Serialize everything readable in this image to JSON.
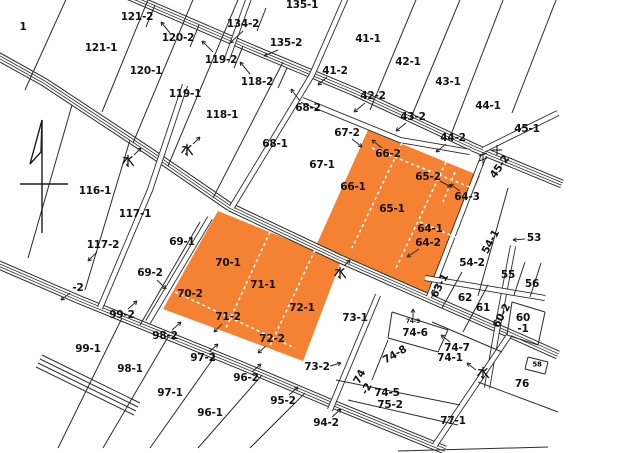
{
  "map": {
    "type": "cadastral-parcel-map",
    "colors": {
      "highlight": "#F58233",
      "line": "#2b2b2b",
      "background": "#ffffff",
      "text": "#121212"
    },
    "highlighted_parcels": {
      "upper_block": [
        "66-2",
        "66-1",
        "65-2",
        "65-1",
        "64-3",
        "64-1",
        "64-2"
      ],
      "lower_block": [
        "70-1",
        "70-2",
        "71-1",
        "71-2",
        "72-1",
        "72-2"
      ]
    },
    "water_mark_meaning": "水",
    "labels": [
      {
        "text": "1",
        "x": 23,
        "y": 27
      },
      {
        "text": "121-2",
        "x": 137,
        "y": 17
      },
      {
        "text": "134-2",
        "x": 243,
        "y": 24
      },
      {
        "text": "135-1",
        "x": 302,
        "y": 5
      },
      {
        "text": "120-2",
        "x": 178,
        "y": 38
      },
      {
        "text": "135-2",
        "x": 286,
        "y": 43
      },
      {
        "text": "41-1",
        "x": 368,
        "y": 39
      },
      {
        "text": "121-1",
        "x": 101,
        "y": 48
      },
      {
        "text": "119-2",
        "x": 221,
        "y": 60
      },
      {
        "text": "42-1",
        "x": 408,
        "y": 62
      },
      {
        "text": "120-1",
        "x": 146,
        "y": 71
      },
      {
        "text": "41-2",
        "x": 335,
        "y": 71
      },
      {
        "text": "118-2",
        "x": 257,
        "y": 82
      },
      {
        "text": "43-1",
        "x": 448,
        "y": 82
      },
      {
        "text": "119-1",
        "x": 185,
        "y": 94
      },
      {
        "text": "42-2",
        "x": 373,
        "y": 96
      },
      {
        "text": "44-1",
        "x": 488,
        "y": 106
      },
      {
        "text": "68-2",
        "x": 308,
        "y": 108
      },
      {
        "text": "118-1",
        "x": 222,
        "y": 115
      },
      {
        "text": "43-2",
        "x": 413,
        "y": 117
      },
      {
        "text": "45-1",
        "x": 527,
        "y": 129
      },
      {
        "text": "67-2",
        "x": 347,
        "y": 133
      },
      {
        "text": "44-2",
        "x": 453,
        "y": 138
      },
      {
        "text": "68-1",
        "x": 275,
        "y": 144
      },
      {
        "text": "66-2",
        "x": 388,
        "y": 154
      },
      {
        "text": "水",
        "x": 128,
        "y": 161,
        "glyph": "mizu"
      },
      {
        "text": "水",
        "x": 187,
        "y": 150,
        "glyph": "mizu"
      },
      {
        "text": "67-1",
        "x": 322,
        "y": 165
      },
      {
        "text": "45-2",
        "x": 500,
        "y": 167,
        "rot": -55
      },
      {
        "text": "65-2",
        "x": 428,
        "y": 177
      },
      {
        "text": "66-1",
        "x": 353,
        "y": 187
      },
      {
        "text": "116-1",
        "x": 95,
        "y": 191
      },
      {
        "text": "64-3",
        "x": 467,
        "y": 197
      },
      {
        "text": "65-1",
        "x": 392,
        "y": 209
      },
      {
        "text": "117-1",
        "x": 135,
        "y": 214
      },
      {
        "text": "64-1",
        "x": 430,
        "y": 229
      },
      {
        "text": "53",
        "x": 534,
        "y": 238
      },
      {
        "text": "54-1",
        "x": 491,
        "y": 242,
        "rot": -62
      },
      {
        "text": "64-2",
        "x": 428,
        "y": 243
      },
      {
        "text": "69-1",
        "x": 182,
        "y": 242
      },
      {
        "text": "117-2",
        "x": 103,
        "y": 245
      },
      {
        "text": "54-2",
        "x": 472,
        "y": 263
      },
      {
        "text": "70-1",
        "x": 228,
        "y": 263
      },
      {
        "text": "69-2",
        "x": 150,
        "y": 273
      },
      {
        "text": "水",
        "x": 340,
        "y": 273,
        "glyph": "mizu"
      },
      {
        "text": "55",
        "x": 508,
        "y": 275
      },
      {
        "text": "56",
        "x": 532,
        "y": 284
      },
      {
        "text": "71-1",
        "x": 263,
        "y": 285
      },
      {
        "text": "63-1",
        "x": 440,
        "y": 286,
        "rot": -62
      },
      {
        "text": "-2",
        "x": 78,
        "y": 288
      },
      {
        "text": "70-2",
        "x": 190,
        "y": 294
      },
      {
        "text": "62",
        "x": 465,
        "y": 298
      },
      {
        "text": "61",
        "x": 483,
        "y": 308
      },
      {
        "text": "72-1",
        "x": 302,
        "y": 308
      },
      {
        "text": "99-2",
        "x": 122,
        "y": 315
      },
      {
        "text": "60-2",
        "x": 502,
        "y": 316,
        "rot": -62
      },
      {
        "text": "71-2",
        "x": 228,
        "y": 317
      },
      {
        "text": "73-1",
        "x": 355,
        "y": 318
      },
      {
        "text": "60",
        "x": 523,
        "y": 318
      },
      {
        "text": "74-9",
        "x": 413,
        "y": 322,
        "size": 6
      },
      {
        "text": "-1",
        "x": 523,
        "y": 329
      },
      {
        "text": "74-6",
        "x": 415,
        "y": 333
      },
      {
        "text": "98-2",
        "x": 165,
        "y": 336
      },
      {
        "text": "72-2",
        "x": 272,
        "y": 339
      },
      {
        "text": "74-7",
        "x": 457,
        "y": 348
      },
      {
        "text": "99-1",
        "x": 88,
        "y": 349
      },
      {
        "text": "74-8",
        "x": 395,
        "y": 355,
        "rot": -30
      },
      {
        "text": "74-1",
        "x": 450,
        "y": 358
      },
      {
        "text": "97-2",
        "x": 203,
        "y": 358
      },
      {
        "text": "58",
        "x": 537,
        "y": 365,
        "size": 7
      },
      {
        "text": "73-2",
        "x": 317,
        "y": 367
      },
      {
        "text": "98-1",
        "x": 130,
        "y": 369
      },
      {
        "text": "水",
        "x": 483,
        "y": 373,
        "glyph": "mizu"
      },
      {
        "text": "96-2",
        "x": 246,
        "y": 378
      },
      {
        "text": "74",
        "x": 360,
        "y": 377,
        "rot": -62
      },
      {
        "text": "-2",
        "x": 367,
        "y": 389,
        "rot": -62
      },
      {
        "text": "76",
        "x": 522,
        "y": 384
      },
      {
        "text": "74-5",
        "x": 387,
        "y": 393
      },
      {
        "text": "97-1",
        "x": 170,
        "y": 393
      },
      {
        "text": "95-2",
        "x": 283,
        "y": 401
      },
      {
        "text": "75-2",
        "x": 390,
        "y": 405
      },
      {
        "text": "96-1",
        "x": 210,
        "y": 413
      },
      {
        "text": "77-1",
        "x": 453,
        "y": 421
      },
      {
        "text": "94-2",
        "x": 326,
        "y": 423
      }
    ]
  }
}
